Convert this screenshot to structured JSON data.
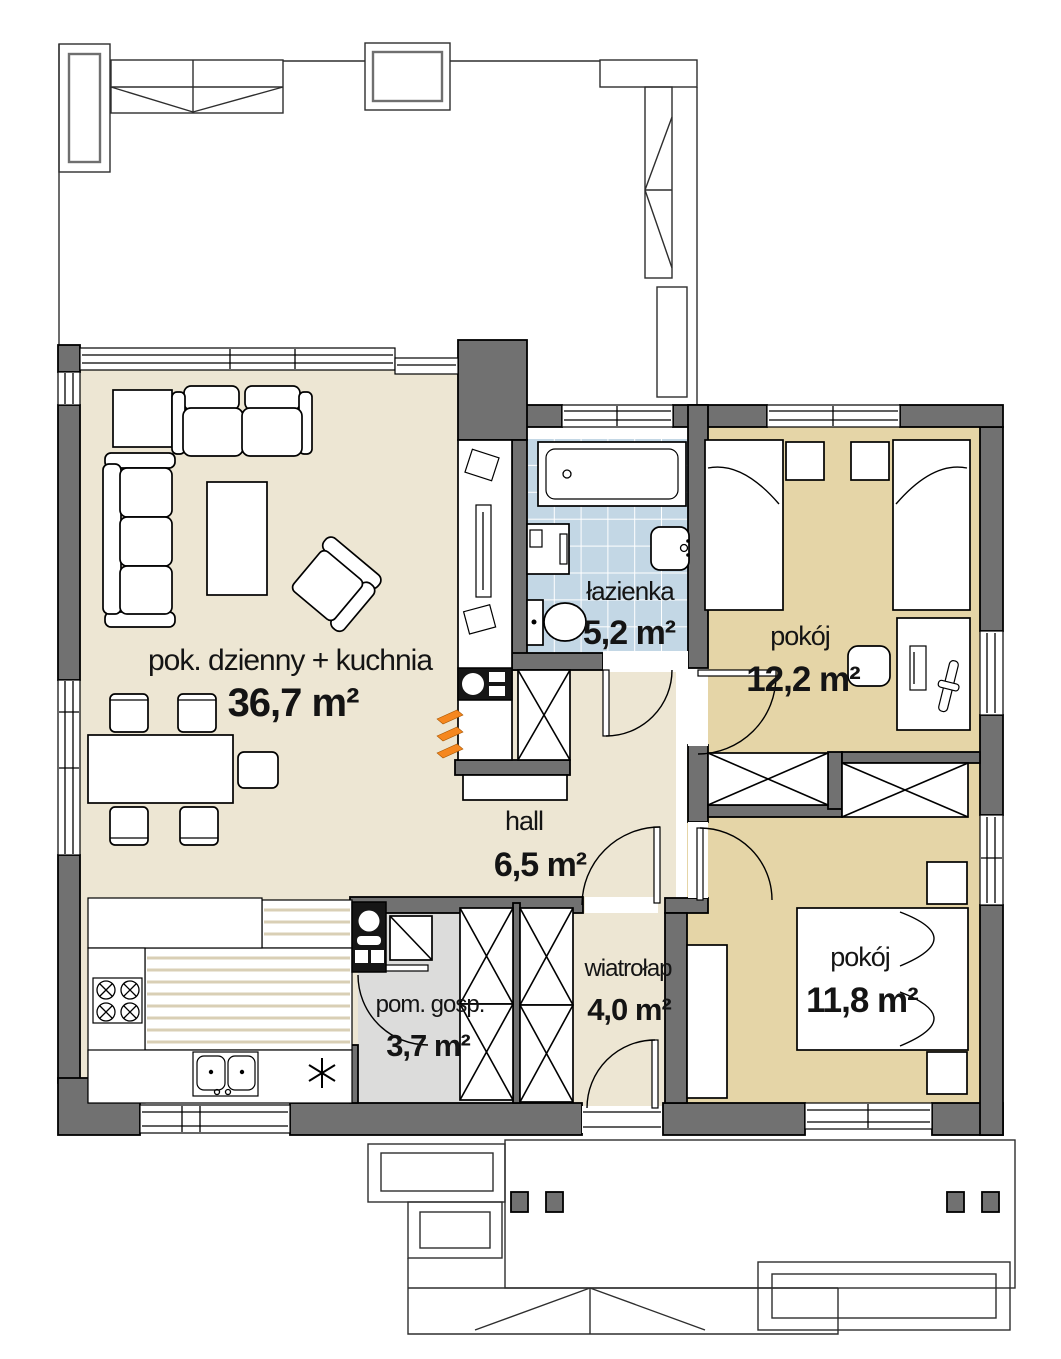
{
  "plan_type": "floor-plan",
  "rooms": {
    "living": {
      "label": "pok. dzienny + kuchnia",
      "area": "36,7 m²"
    },
    "bathroom": {
      "label": "łazienka",
      "area": "5,2 m²"
    },
    "bedroom1": {
      "label": "pokój",
      "area": "12,2 m²"
    },
    "hall": {
      "label": "hall",
      "area": "6,5 m²"
    },
    "vestibule": {
      "label": "wiatrołap",
      "area": "4,0 m²"
    },
    "utility": {
      "label": "pom. gosp.",
      "area": "3,7 m²"
    },
    "bedroom2": {
      "label": "pokój",
      "area": "11,8 m²"
    }
  },
  "colors": {
    "wall": "#717171",
    "floor_main": "#EDE6D3",
    "floor_bedroom": "#E5D5A7",
    "floor_bath": "#C3D7E5",
    "floor_utility": "#DCDCDB",
    "radiator": "#F5871F"
  }
}
